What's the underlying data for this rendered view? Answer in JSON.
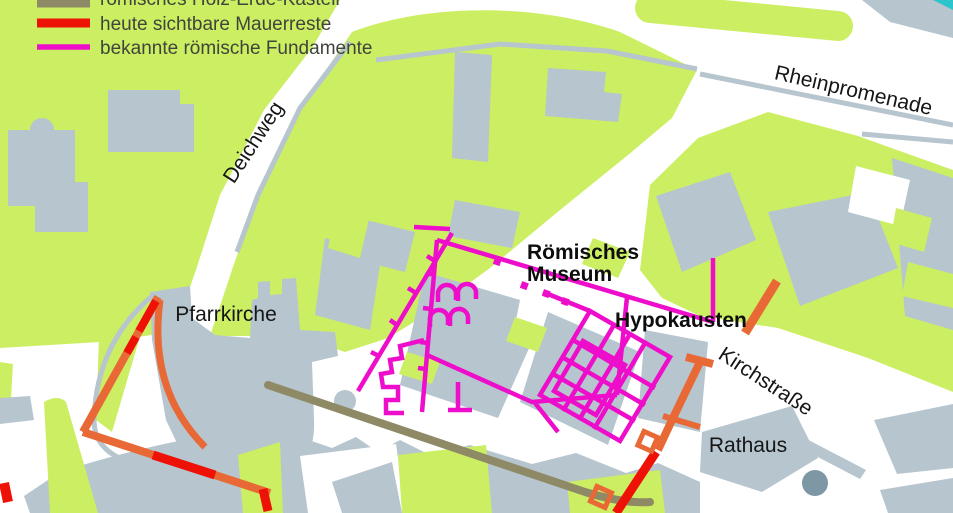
{
  "legend": {
    "items": [
      {
        "label": "römisches Holz-Erde-Kastell",
        "swatch_color": "#8f8a66"
      },
      {
        "label": "heute sichtbare Mauerreste",
        "swatch_color": "#ee1105"
      },
      {
        "label": "bekannte römische Fundamente",
        "swatch_color": "#ee0dca"
      }
    ]
  },
  "labels": {
    "deichweg": "Deichweg",
    "rheinpromenade": "Rheinpromenade",
    "pfarrkirche": "Pfarrkirche",
    "museum_line1": "Römisches",
    "museum_line2": "Museum",
    "hypokausten": "Hypokausten",
    "kirchstrasse": "Kirchstraße",
    "rathaus": "Rathaus"
  },
  "colors": {
    "vegetation": "#ccee62",
    "building": "#b6c5ce",
    "street": "#ffffff",
    "wood_earth_fort_line": "#8f8a66",
    "visible_wall_remains": "#ee1105",
    "roman_foundations": "#ee0dca",
    "water": "#2ec4cc",
    "dark_dot": "#7d97a4",
    "street_label_text": "#161616",
    "legend_text": "#3f443c"
  }
}
